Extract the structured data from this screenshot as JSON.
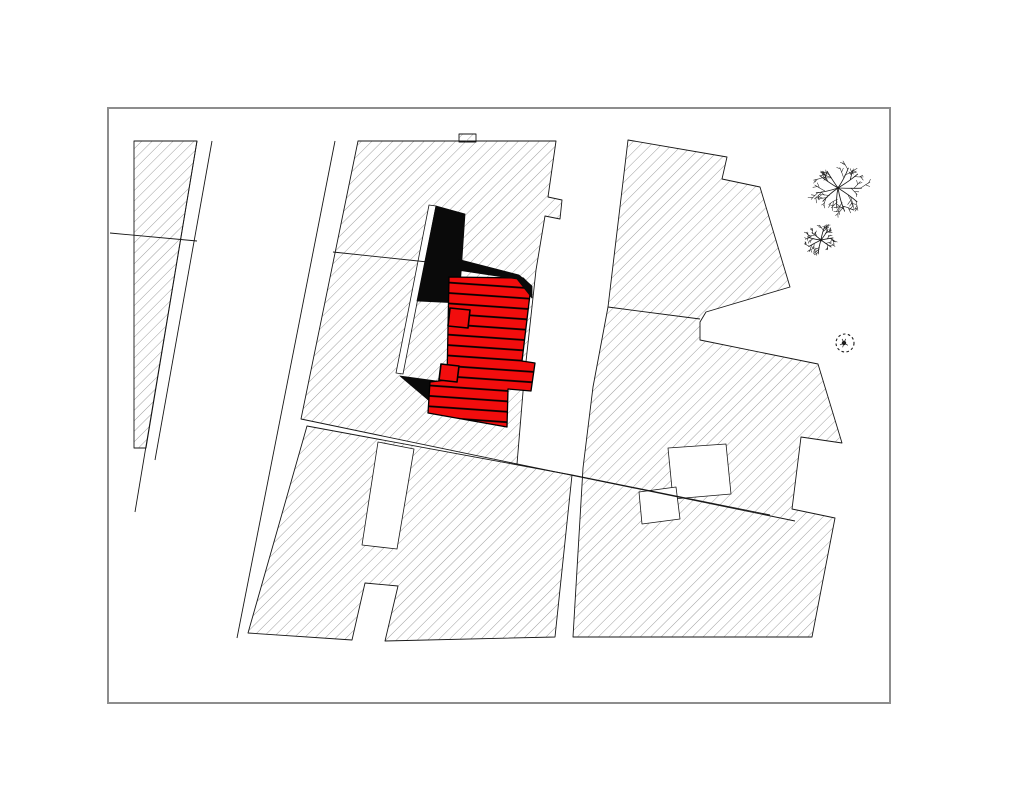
{
  "canvas": {
    "w": 1024,
    "h": 791,
    "bg": "#ffffff"
  },
  "frame": {
    "x": 108,
    "y": 108,
    "w": 782,
    "h": 595,
    "stroke": "#8d8d8d",
    "stroke_width": 2
  },
  "colors": {
    "outline": "#161616",
    "hatch_line": "#6a6a6a",
    "building_red": "#f20d0d",
    "stripe_black": "#000000",
    "roof_black": "#0a0a0a",
    "white": "#ffffff",
    "tree": "#1b1b1b"
  },
  "hatch": {
    "spacing": 7.4,
    "line_width": 0.65,
    "angle": 45
  },
  "stripes": {
    "spacing": 10.4,
    "line_width": 1.7,
    "angle": 4
  },
  "hatched_blocks": [
    {
      "name": "parcel-strip-west",
      "pts": [
        [
          134,
          141
        ],
        [
          197,
          141
        ],
        [
          146,
          448
        ],
        [
          134,
          448
        ]
      ]
    },
    {
      "name": "parcel-block-center",
      "pts": [
        [
          358,
          141
        ],
        [
          556,
          141
        ],
        [
          548,
          197
        ],
        [
          562,
          200
        ],
        [
          560,
          219
        ],
        [
          545,
          216
        ],
        [
          536,
          270
        ],
        [
          524,
          380
        ],
        [
          517,
          464
        ],
        [
          301,
          419
        ]
      ]
    },
    {
      "name": "parcel-block-center-bump",
      "pts": [
        [
          459,
          134
        ],
        [
          476,
          134
        ],
        [
          476,
          142
        ],
        [
          459,
          142
        ]
      ]
    },
    {
      "name": "parcel-block-south",
      "pts": [
        [
          307,
          426
        ],
        [
          572,
          475
        ],
        [
          555,
          637
        ],
        [
          385,
          641
        ],
        [
          398,
          586
        ],
        [
          365,
          583
        ],
        [
          352,
          640
        ],
        [
          248,
          633
        ]
      ]
    },
    {
      "name": "parcel-block-east",
      "pts": [
        [
          628,
          140
        ],
        [
          727,
          157
        ],
        [
          722,
          179
        ],
        [
          760,
          187
        ],
        [
          790,
          287
        ],
        [
          706,
          312
        ],
        [
          700,
          322
        ],
        [
          700,
          340
        ],
        [
          818,
          364
        ],
        [
          842,
          443
        ],
        [
          801,
          437
        ],
        [
          792,
          509
        ],
        [
          835,
          518
        ],
        [
          812,
          637
        ],
        [
          573,
          637
        ],
        [
          583,
          468
        ],
        [
          593,
          387
        ],
        [
          608,
          307
        ]
      ]
    }
  ],
  "white_cutouts": [
    {
      "name": "courtyard-path-west-of-building",
      "pts": [
        [
          436,
          206
        ],
        [
          417,
          303
        ],
        [
          403,
          374
        ],
        [
          396,
          373
        ],
        [
          410,
          302
        ],
        [
          429,
          205
        ]
      ]
    },
    {
      "name": "courtyard-slot-south",
      "pts": [
        [
          378,
          442
        ],
        [
          414,
          449
        ],
        [
          397,
          549
        ],
        [
          362,
          545
        ]
      ]
    },
    {
      "name": "courtyard-east-1",
      "pts": [
        [
          668,
          448
        ],
        [
          726,
          444
        ],
        [
          731,
          494
        ],
        [
          673,
          499
        ]
      ]
    },
    {
      "name": "courtyard-east-2",
      "pts": [
        [
          639,
          492
        ],
        [
          676,
          487
        ],
        [
          680,
          519
        ],
        [
          642,
          524
        ]
      ]
    }
  ],
  "boundary_lines": [
    {
      "name": "road-edge-west-inner",
      "pts": [
        [
          197,
          141
        ],
        [
          135,
          512
        ]
      ]
    },
    {
      "name": "road-edge-west-outer",
      "pts": [
        [
          212,
          141
        ],
        [
          155,
          460
        ]
      ]
    },
    {
      "name": "road-edge-center",
      "pts": [
        [
          335,
          141
        ],
        [
          237,
          638
        ]
      ]
    },
    {
      "name": "parcel-line-west",
      "pts": [
        [
          110,
          233
        ],
        [
          197,
          241
        ]
      ]
    },
    {
      "name": "parcel-line-center",
      "pts": [
        [
          333,
          252
        ],
        [
          437,
          263
        ]
      ]
    },
    {
      "name": "parcel-line-east",
      "pts": [
        [
          608,
          307
        ],
        [
          700,
          319
        ]
      ]
    },
    {
      "name": "street-line-south-upper",
      "pts": [
        [
          517,
          464
        ],
        [
          795,
          521
        ]
      ]
    },
    {
      "name": "street-line-south-lower",
      "pts": [
        [
          572,
          475
        ],
        [
          770,
          515
        ]
      ]
    }
  ],
  "roof_shadows": [
    {
      "name": "roof-shadow-slab",
      "pts": [
        [
          436,
          206
        ],
        [
          465,
          214
        ],
        [
          459,
          303
        ],
        [
          417,
          301
        ]
      ]
    },
    {
      "name": "roof-shadow-south-wedge",
      "pts": [
        [
          400,
          376
        ],
        [
          444,
          382
        ],
        [
          446,
          415
        ]
      ]
    }
  ],
  "roof_shadow_ridge": {
    "name": "roof-shadow-ridge",
    "pts": [
      [
        457,
        259
      ],
      [
        519,
        275
      ],
      [
        532,
        286
      ],
      [
        532,
        298
      ],
      [
        517,
        279
      ],
      [
        457,
        270
      ]
    ]
  },
  "building": {
    "name": "highlighted-building",
    "main_pts": [
      [
        449,
        277
      ],
      [
        523,
        278
      ],
      [
        531,
        286
      ],
      [
        522,
        361
      ],
      [
        535,
        363
      ],
      [
        531,
        391
      ],
      [
        508,
        389
      ],
      [
        507,
        427
      ],
      [
        428,
        413
      ],
      [
        430,
        382
      ],
      [
        447,
        380
      ]
    ],
    "tabs": [
      [
        [
          450,
          308
        ],
        [
          470,
          310
        ],
        [
          468,
          328
        ],
        [
          448,
          326
        ]
      ],
      [
        [
          441,
          364
        ],
        [
          459,
          366
        ],
        [
          457,
          382
        ],
        [
          439,
          380
        ]
      ]
    ]
  },
  "trees": [
    {
      "name": "tree-symbol-large",
      "cx": 838,
      "cy": 188,
      "r": 27,
      "seed": 11
    },
    {
      "name": "tree-symbol-small",
      "cx": 821,
      "cy": 240,
      "r": 16,
      "seed": 29
    }
  ],
  "shrub": {
    "name": "shrub-symbol-dashed",
    "cx": 845,
    "cy": 343,
    "r": 9,
    "dash": "2.6 2.4"
  }
}
